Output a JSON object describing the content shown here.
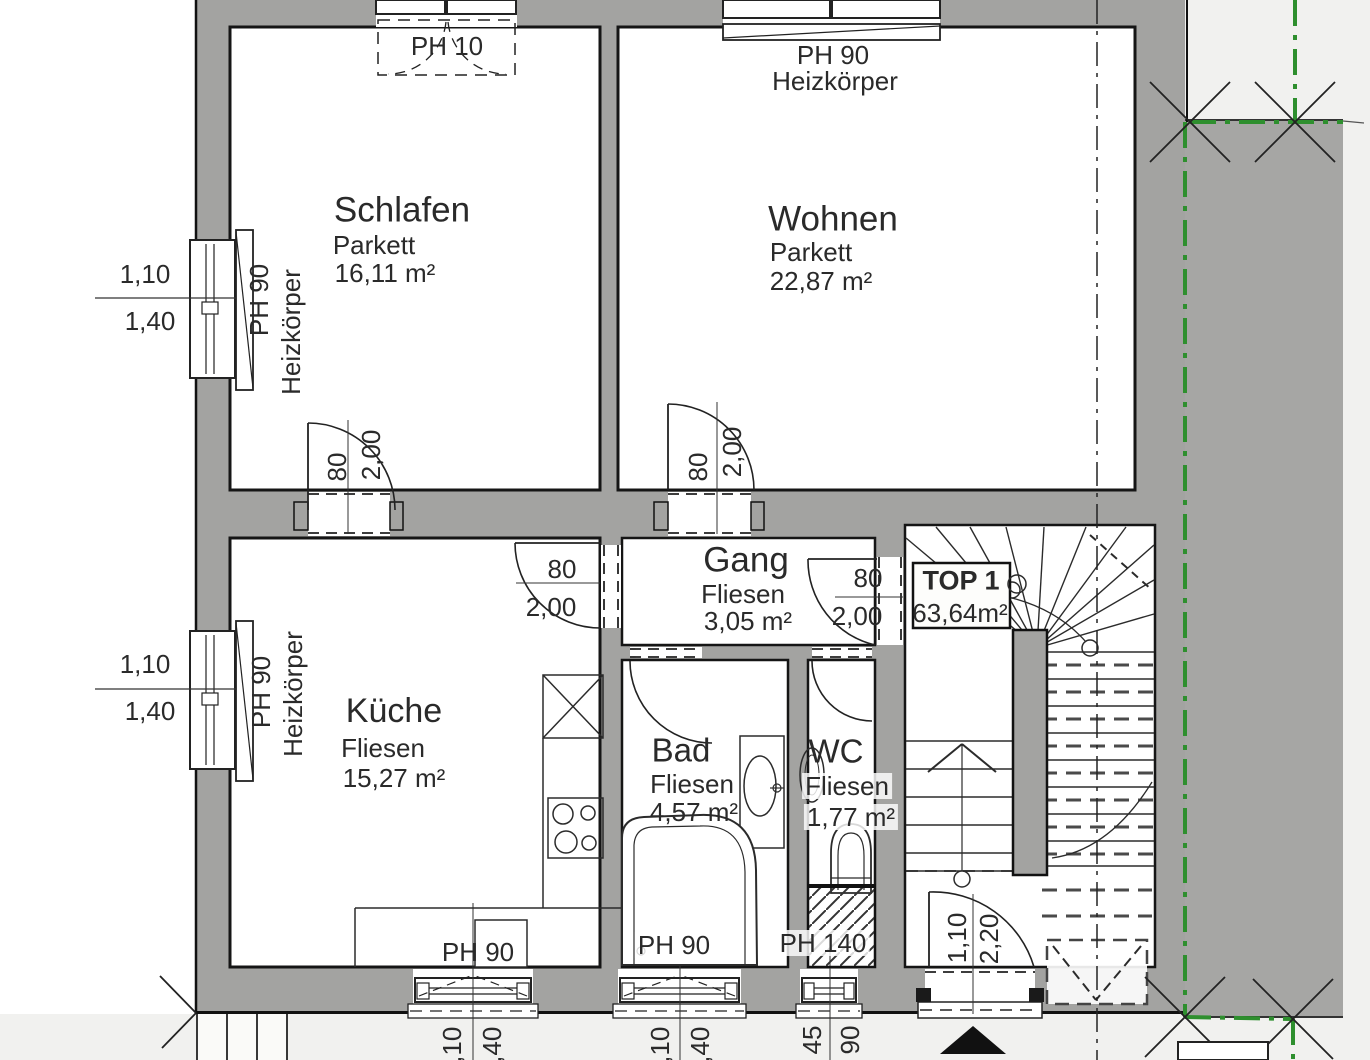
{
  "plan": {
    "unit_box": {
      "label": "TOP 1",
      "area": "63,64m²"
    },
    "rooms": {
      "schlafen": {
        "name": "Schlafen",
        "floor": "Parkett",
        "area": "16,11 m²"
      },
      "wohnen": {
        "name": "Wohnen",
        "floor": "Parkett",
        "area": "22,87 m²"
      },
      "kueche": {
        "name": "Küche",
        "floor": "Fliesen",
        "area": "15,27 m²"
      },
      "gang": {
        "name": "Gang",
        "floor": "Fliesen",
        "area": "3,05 m²"
      },
      "bad": {
        "name": "Bad",
        "floor": "Fliesen",
        "area": "4,57 m²"
      },
      "wc": {
        "name": "WC",
        "floor": "Fliesen",
        "area": "1,77 m²"
      }
    },
    "windows": {
      "schlafen_top": {
        "label": "PH 10"
      },
      "wohnen_top": {
        "label": "PH 90",
        "sub": "Heizkörper"
      },
      "left_schlafen": {
        "label": "PH 90",
        "sub": "Heizkörper",
        "dim_top": "1,10",
        "dim_bottom": "1,40"
      },
      "left_kueche": {
        "label": "PH 90",
        "sub": "Heizkörper",
        "dim_top": "1,10",
        "dim_bottom": "1,40"
      },
      "bottom_kueche": {
        "label": "PH 90",
        "dim_left": "1,10",
        "dim_right": "1,40"
      },
      "bottom_bad": {
        "label": "PH 90",
        "dim_left": "1,10",
        "dim_right": "1,40"
      },
      "bottom_wc": {
        "label": "PH 140",
        "dim_left": "45",
        "dim_right": "90"
      }
    },
    "doors": {
      "schlafen": {
        "width": "80",
        "height": "2,00"
      },
      "wohnen": {
        "width": "80",
        "height": "2,00"
      },
      "kueche": {
        "width": "80",
        "height": "2,00"
      },
      "stair": {
        "width": "80",
        "height": "2,00"
      },
      "entrance": {
        "width": "1,10",
        "height": "2,20"
      }
    },
    "colors": {
      "wall": "#a3a3a1",
      "neighbor": "#a6a6a4",
      "boundary": "#2e8f2e",
      "outside": "#f1f1ef"
    }
  }
}
